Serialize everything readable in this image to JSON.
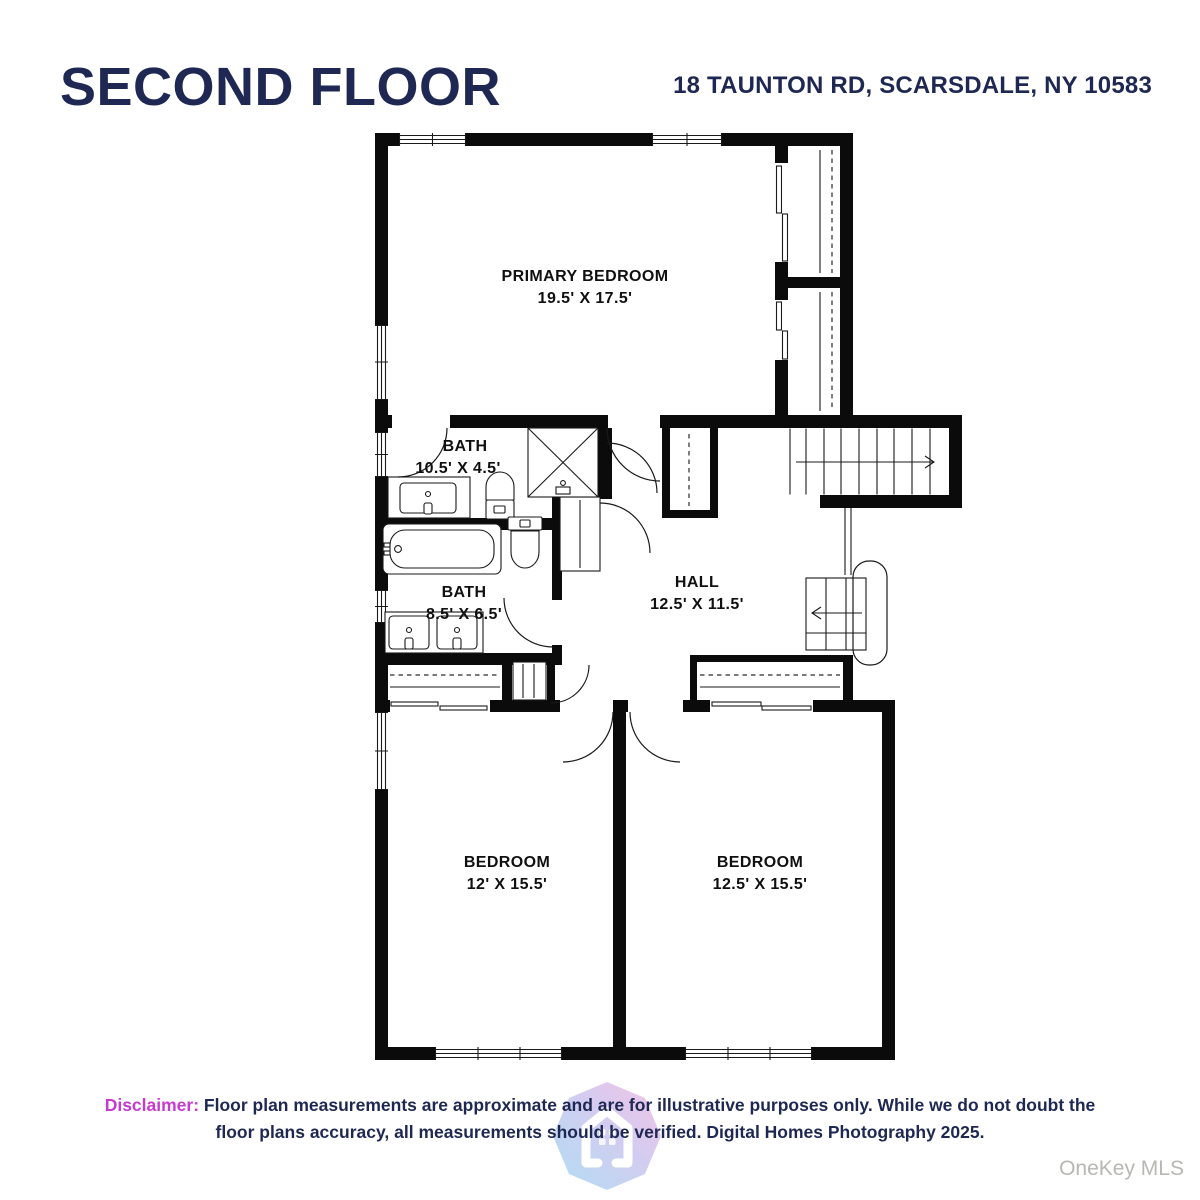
{
  "header": {
    "title": "SECOND FLOOR",
    "address": "18 TAUNTON RD, SCARSDALE, NY 10583"
  },
  "colors": {
    "navy": "#1e2852",
    "magenta": "#c73ad0",
    "wall": "#0b0b0b",
    "watermark": "#b7b7b4",
    "logo-blue": "#9fd7f2",
    "logo-pink": "#f2b7e3"
  },
  "rooms": [
    {
      "name": "PRIMARY BEDROOM",
      "dims": "19.5' X 17.5'"
    },
    {
      "name": "BATH",
      "dims": "10.5' X 4.5'"
    },
    {
      "name": "BATH",
      "dims": "8.5' X 6.5'"
    },
    {
      "name": "HALL",
      "dims": "12.5' X 11.5'"
    },
    {
      "name": "BEDROOM",
      "dims": "12' X 15.5'"
    },
    {
      "name": "BEDROOM",
      "dims": "12.5' X 15.5'"
    }
  ],
  "disclaimer": {
    "label": "Disclaimer:",
    "line1": "Floor plan measurements are approximate and are for illustrative purposes only. While we do not doubt the",
    "line2": "floor plans accuracy, all measurements should be verified. Digital Homes Photography 2025."
  },
  "watermark": "OneKey MLS"
}
